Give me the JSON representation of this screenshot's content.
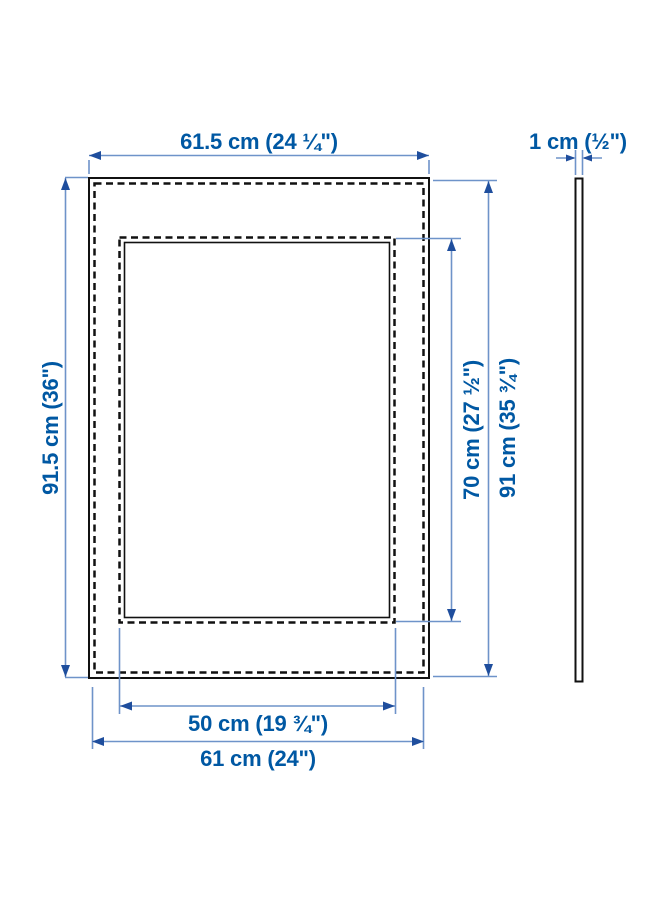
{
  "page": {
    "kind": "product-dimension-diagram",
    "background": "#ffffff"
  },
  "colors": {
    "label_text": "#0058A3",
    "dimension_line": "#6E93C9",
    "arrowhead": "#1F4E9D",
    "frame_outline": "#111111"
  },
  "diagram": {
    "front_view": {
      "outer_width": "61.5 cm (24 ¼\")",
      "outer_height": "91.5 cm (36\")",
      "opening_height": "70 cm (27 ½\")",
      "frame_right_height": "91 cm (35 ¾\")",
      "opening_width": "50 cm (19 ¾\")",
      "frame_bottom_width": "61 cm (24\")"
    },
    "side_view": {
      "depth": "1 cm (½\")"
    }
  }
}
